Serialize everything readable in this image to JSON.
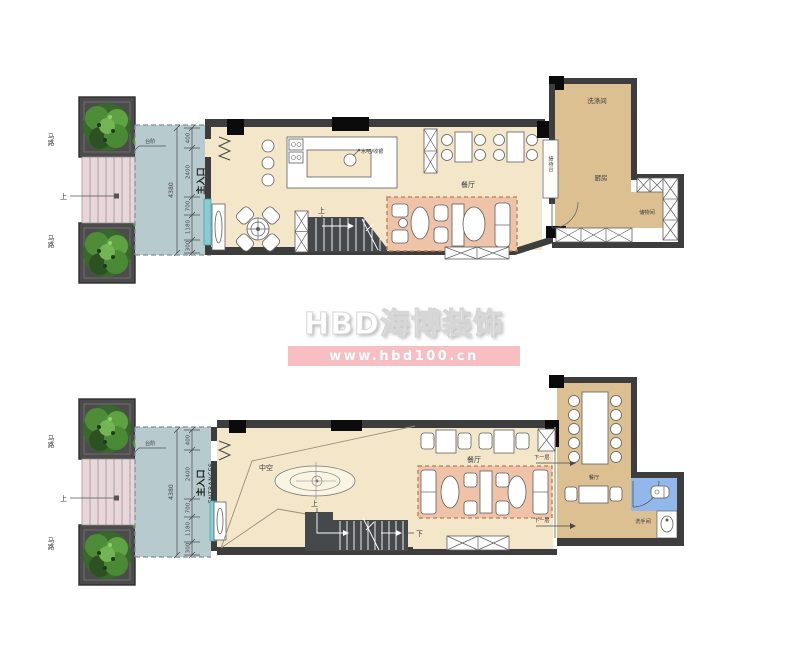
{
  "watermark": {
    "brand": "HBD海博装饰",
    "url": "www.hbd100.cn"
  },
  "shared": {
    "road_label": "马路",
    "up_label": "上",
    "steps_note": "台阶",
    "entrance_en": "ENTRANCES",
    "entrance_cn": "主入口",
    "dim_total": "4380",
    "dim_segments": [
      "400",
      "2400",
      "700",
      "1180",
      "300"
    ]
  },
  "upper_plan": {
    "labels": {
      "bar": "水吧/收银",
      "dining": "餐厅",
      "stairs_up": "上",
      "reception": "接待台",
      "laundry": "洗涤间",
      "kitchen": "厨房",
      "storage": "储物间"
    }
  },
  "lower_plan": {
    "labels": {
      "void": "中空",
      "dining": "餐厅",
      "to_lower_a": "下一层",
      "to_lower_b": "下一层",
      "stairs_up": "上",
      "stairs_down": "下",
      "private_dining": "餐厅",
      "washroom": "洗手间"
    }
  },
  "colors": {
    "floor": "#f4e6c9",
    "kitchen_floor": "#dcc092",
    "lounge": "#eec3a7",
    "terrace": "#b7cacd",
    "steps": "#e9d6da",
    "wall": "#3d3d3d",
    "window": "#85cdd2",
    "washroom": "#92b7ea",
    "watermark_pink": "#f8bfc3"
  }
}
